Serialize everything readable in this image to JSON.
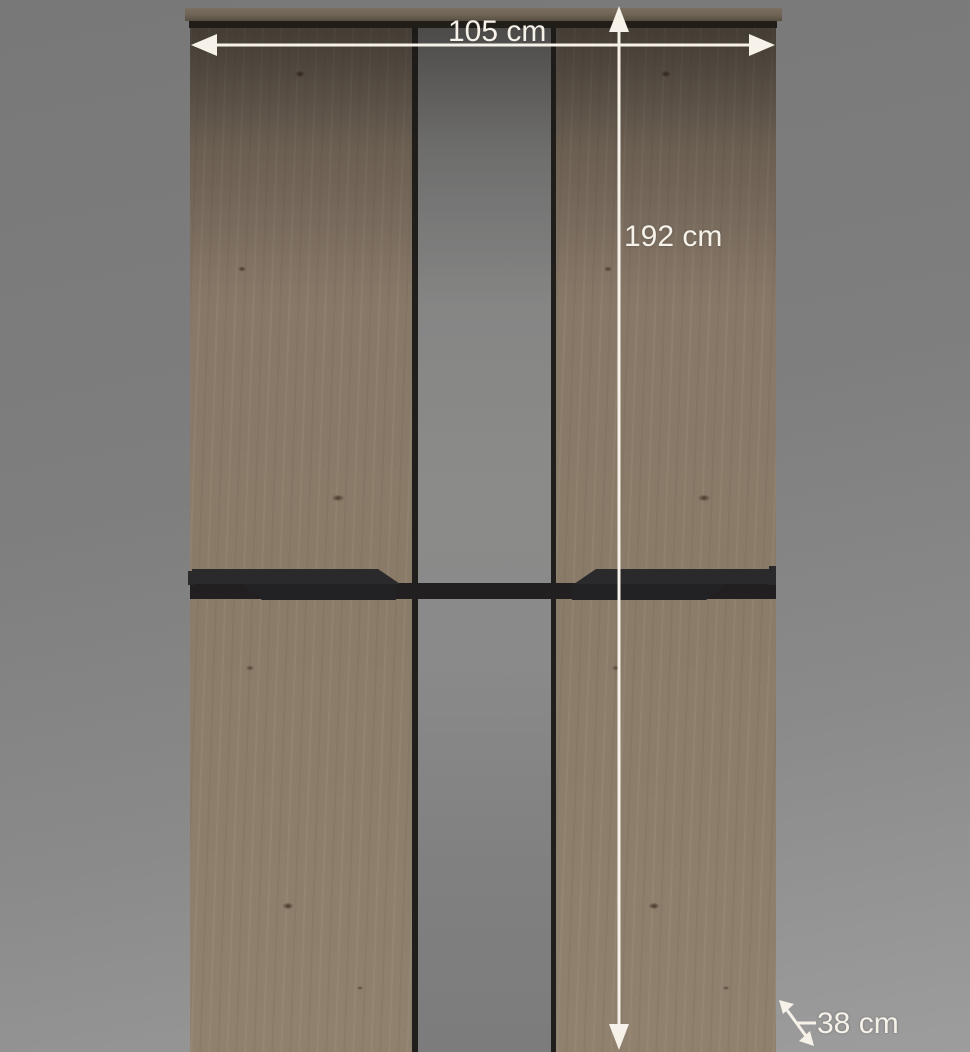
{
  "image": {
    "type": "furniture-dimension-diagram",
    "subject": "two-door wardrobe with wood-grain fronts, central mirror strip and recessed dark handle rail"
  },
  "annotations": {
    "width": {
      "label": "105 cm"
    },
    "height": {
      "label": "192 cm"
    },
    "depth": {
      "label": "38 cm"
    }
  },
  "colors": {
    "background_top": "#787878",
    "background_bottom": "#9d9d9d",
    "wood": "#8a7a68",
    "mirror": "#8a8a8a",
    "handle": "#26242a",
    "annotation": "#f6f2e9"
  }
}
